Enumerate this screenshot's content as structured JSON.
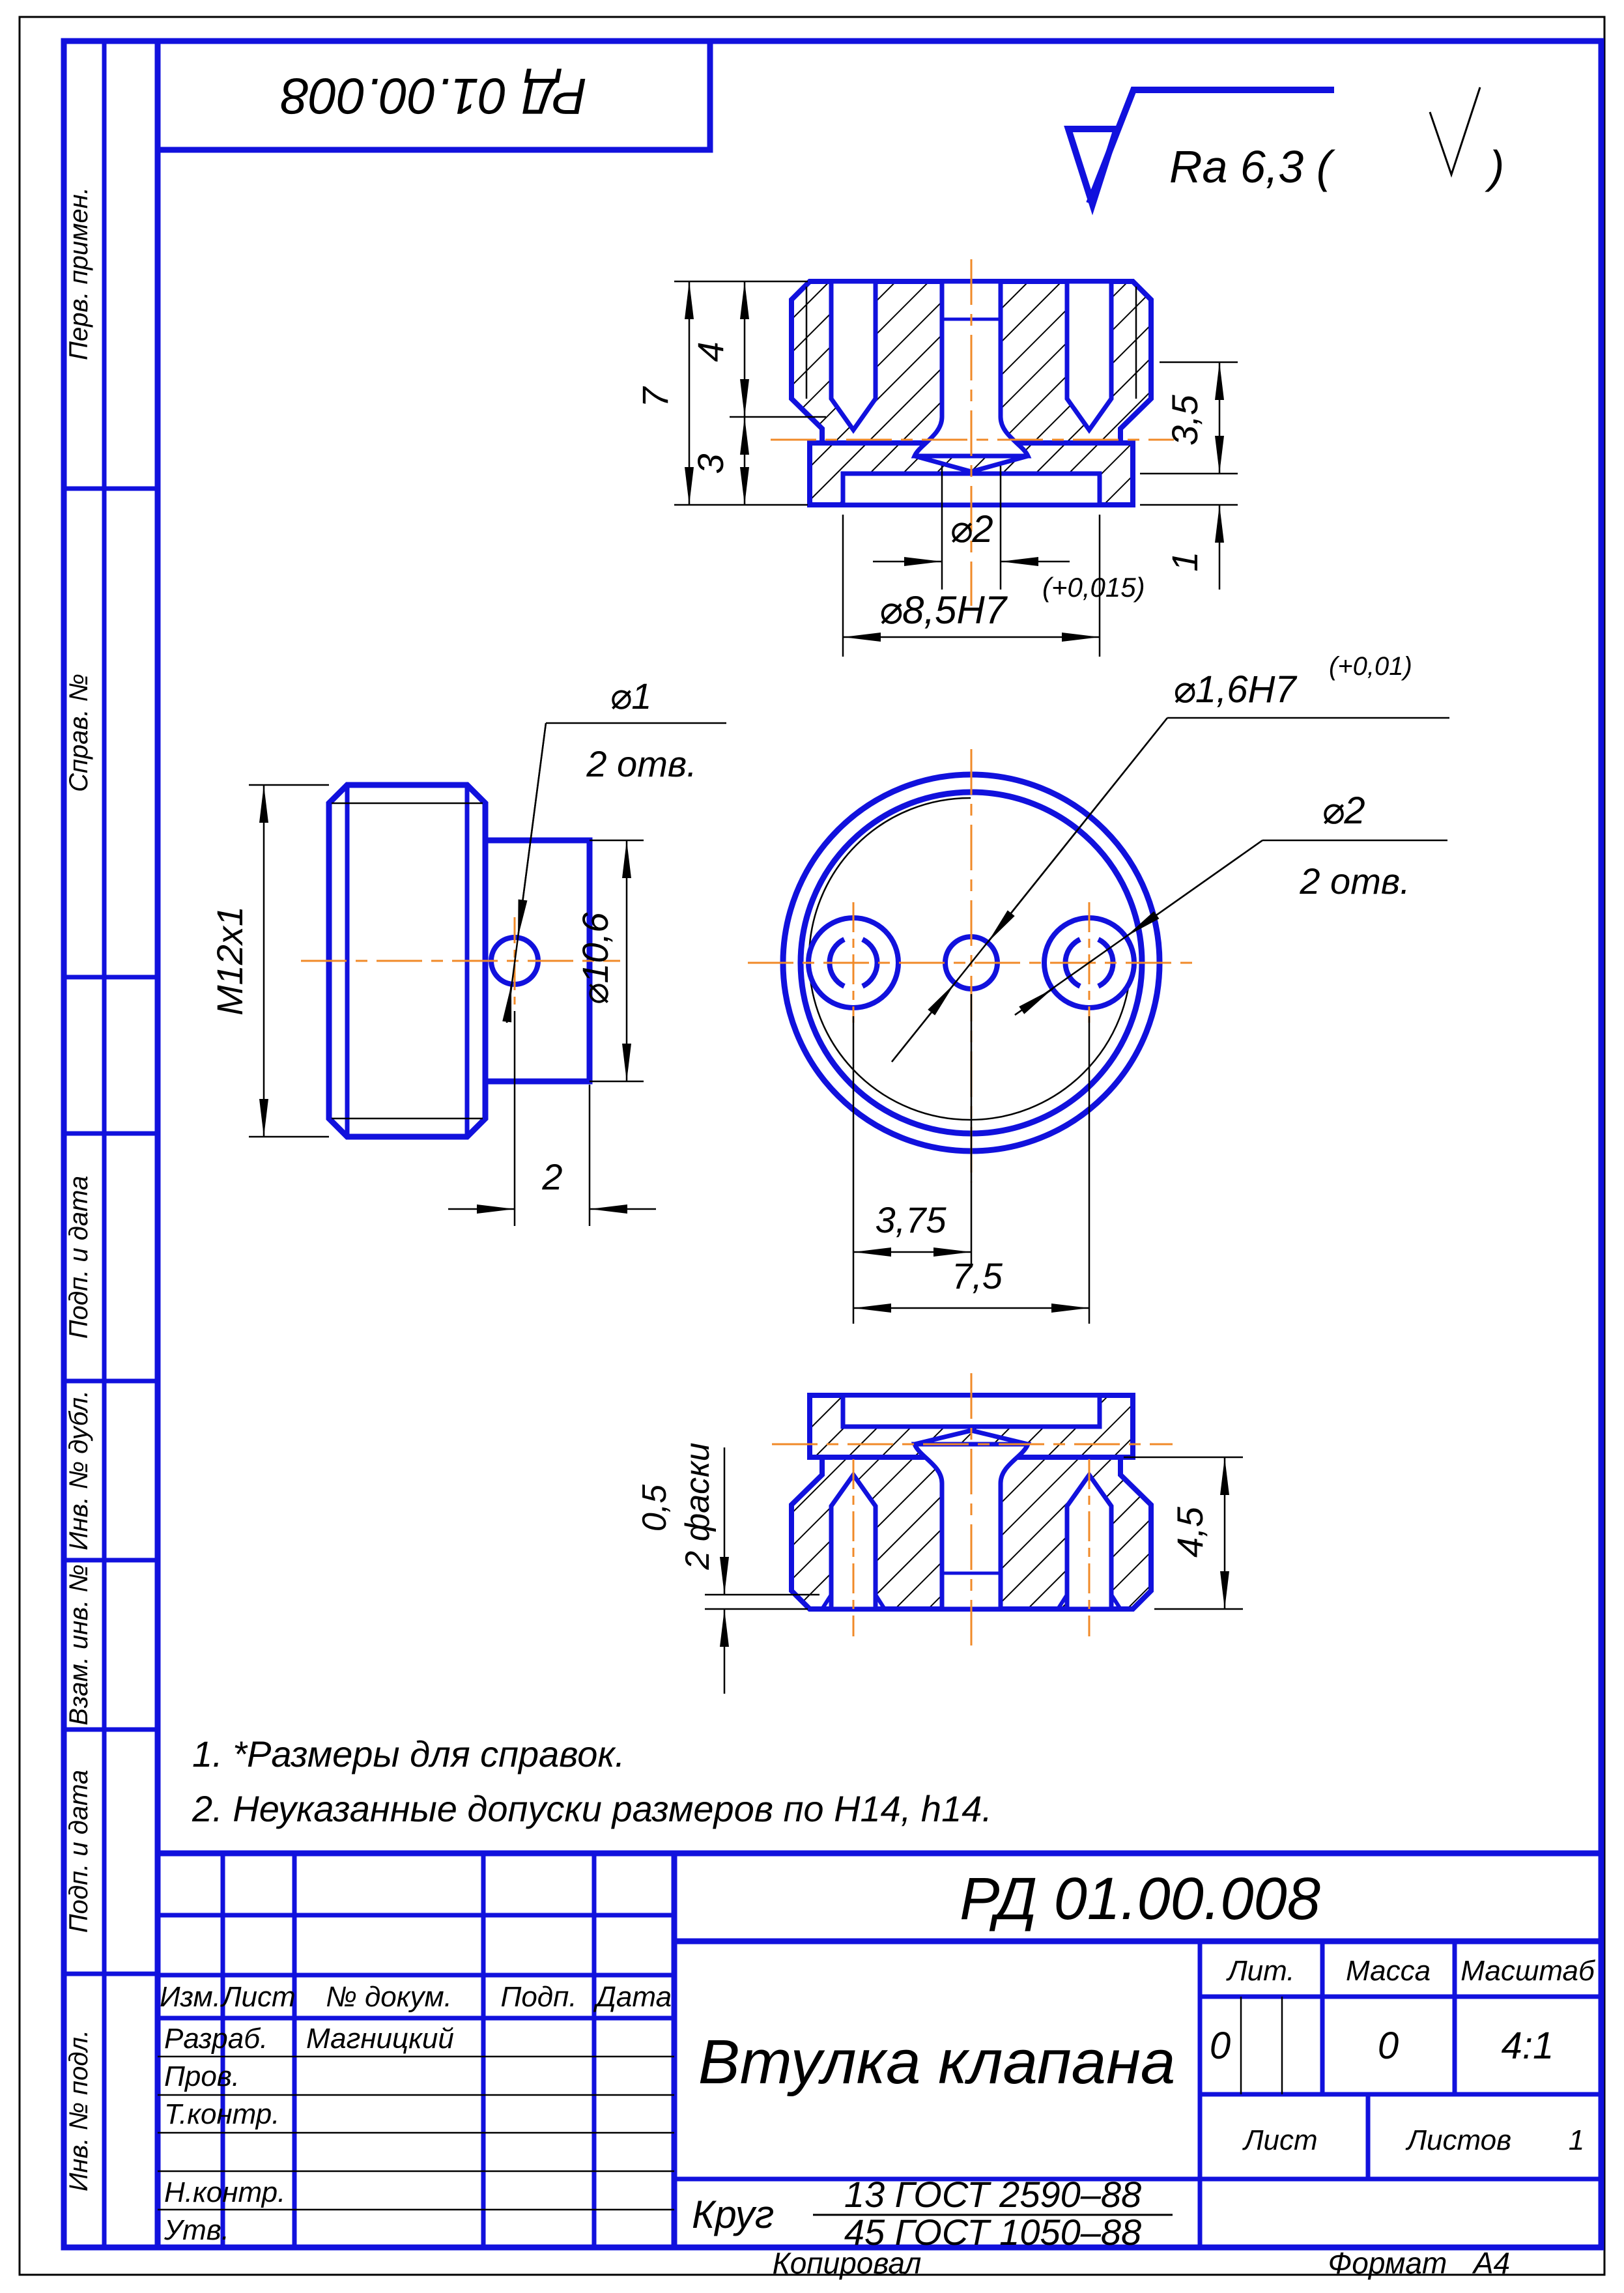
{
  "sheet": {
    "doc_box_flipped": "РД 01.00.008",
    "roughness_prefix": "Ra 6,3 (",
    "roughness_suffix": ")",
    "copied": "Копировал",
    "format_label": "Формат",
    "format_value": "А4",
    "colors": {
      "blue": "#1111dd",
      "orange": "#f08a28",
      "black": "#000000"
    }
  },
  "margin_labels": {
    "perv": "Перв. примен.",
    "sprav": "Справ. №",
    "podp1": "Подп. и дата",
    "inv_dubl": "Инв. № дубл.",
    "vzam": "Взам. инв. №",
    "podp2": "Подп. и дата",
    "inv_podl": "Инв. № подл."
  },
  "views": {
    "top": {
      "h7": "7",
      "h4": "4",
      "h3": "3",
      "h35": "3,5",
      "h1": "1",
      "d2": "⌀2",
      "d85": "⌀8,5H7",
      "d85sup": "(+0,015)"
    },
    "side": {
      "thread": "M12x1",
      "d106": "⌀10,6",
      "off2": "2",
      "d1": "⌀1",
      "d1qty": "2 отв."
    },
    "front": {
      "d16": "⌀1,6H7",
      "d16sup": "(+0,01)",
      "d2": "⌀2",
      "d2qty": "2 отв.",
      "p375": "3,75",
      "p75": "7,5"
    },
    "bottom": {
      "ch05": "0,5",
      "chnote": "2 фаски",
      "h45": "4,5"
    }
  },
  "notes": {
    "n1": "1.  *Размеры для справок.",
    "n2": "2. Неуказанные допуски размеров по H14, h14."
  },
  "tb": {
    "doc_number": "РД 01.00.008",
    "part_name": "Втулка клапана",
    "h_izm": "Изм.",
    "h_list": "Лист",
    "h_doc": "№ докум.",
    "h_podp": "Подп.",
    "h_data": "Дата",
    "r_razrab": "Разраб.",
    "r_prov": "Пров.",
    "r_tkontr": "Т.контр.",
    "r_nkontr": "Н.контр.",
    "r_utv": "Утв.",
    "v_developer": "Магницкий",
    "h_lit": "Лит.",
    "h_massa": "Масса",
    "h_scale": "Масштаб",
    "v_lit": "0",
    "v_massa": "0",
    "v_scale": "4:1",
    "h_list2": "Лист",
    "h_listov": "Листов",
    "v_listov": "1",
    "mat_prefix": "Круг",
    "mat_top": "13 ГОСТ 2590–88",
    "mat_bottom": "45 ГОСТ 1050–88"
  }
}
